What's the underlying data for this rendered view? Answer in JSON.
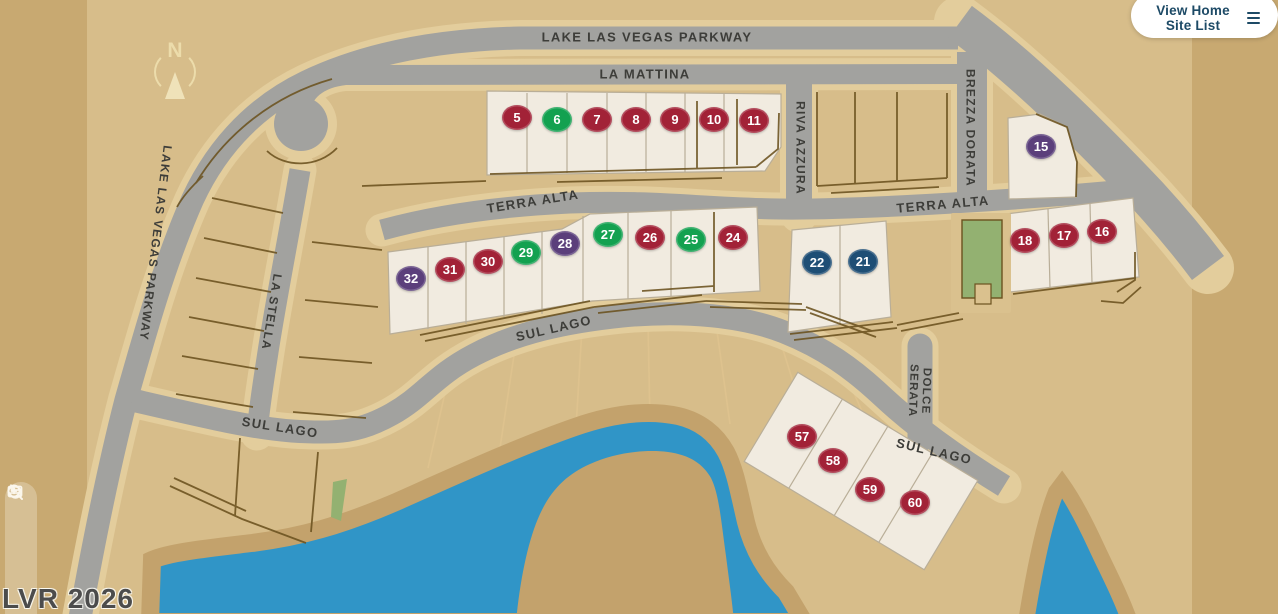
{
  "page": {
    "view_button": {
      "label": "View Home Site List",
      "icon": "list-icon",
      "text_color": "#1d4a66"
    },
    "watermark": "LVR 2026",
    "compass_label": "N",
    "controls": [
      {
        "name": "fit-view"
      },
      {
        "name": "zoom-in"
      },
      {
        "name": "zoom-out"
      },
      {
        "name": "reset-view"
      }
    ]
  },
  "map": {
    "theme": {
      "outer": "#c8a971",
      "map": "#d7bd8a",
      "road": "#a2a29f",
      "roadpad": "#e3cd9c",
      "water": "#3095c7",
      "shore": "#c3a26c",
      "lot": "#f1ebe0",
      "lotline": "#b9ae98",
      "green": "#93b171",
      "ink": "#6b521f",
      "label": "#3d3d39",
      "faint": "#e0c48f",
      "btn": "#1d4a66"
    },
    "status_colors": {
      "red": "#a22237",
      "green": "#13a150",
      "purple": "#5b3f7b",
      "navy": "#1e4e75"
    },
    "street_labels": [
      {
        "text": "LAKE LAS VEGAS PARKWAY",
        "x": 647,
        "y": 38,
        "rot": 0,
        "size": 13
      },
      {
        "text": "LA MATTINA",
        "x": 645,
        "y": 75,
        "rot": 0,
        "size": 13
      },
      {
        "text": "RIVA AZZURA",
        "x": 800,
        "y": 148,
        "rot": 90,
        "size": 12
      },
      {
        "text": "BREZZA DORATA",
        "x": 970,
        "y": 128,
        "rot": 90,
        "size": 12
      },
      {
        "text": "TERRA ALTA",
        "x": 533,
        "y": 202,
        "rot": -9,
        "size": 13
      },
      {
        "text": "TERRA ALTA",
        "x": 943,
        "y": 205,
        "rot": -5,
        "size": 13
      },
      {
        "text": "LAKE LAS VEGAS PARKWAY",
        "x": 155,
        "y": 243,
        "rot": 97,
        "size": 12
      },
      {
        "text": "LA STELLA",
        "x": 271,
        "y": 312,
        "rot": 99,
        "size": 12
      },
      {
        "text": "SUL LAGO",
        "x": 280,
        "y": 428,
        "rot": 9,
        "size": 13
      },
      {
        "text": "SUL LAGO",
        "x": 554,
        "y": 329,
        "rot": -13,
        "size": 13
      },
      {
        "text": "SUL LAGO",
        "x": 934,
        "y": 452,
        "rot": 13,
        "size": 13
      },
      {
        "text": "DOLCE\nSERATA",
        "x": 919,
        "y": 391,
        "rot": 92,
        "size": 11.5
      }
    ],
    "lots": [
      {
        "num": "5",
        "x": 517,
        "y": 117,
        "color": "red"
      },
      {
        "num": "6",
        "x": 557,
        "y": 119,
        "color": "green"
      },
      {
        "num": "7",
        "x": 597,
        "y": 119,
        "color": "red"
      },
      {
        "num": "8",
        "x": 636,
        "y": 119,
        "color": "red"
      },
      {
        "num": "9",
        "x": 675,
        "y": 119,
        "color": "red"
      },
      {
        "num": "10",
        "x": 714,
        "y": 119,
        "color": "red"
      },
      {
        "num": "11",
        "x": 754,
        "y": 120,
        "color": "red"
      },
      {
        "num": "15",
        "x": 1041,
        "y": 146,
        "color": "purple"
      },
      {
        "num": "16",
        "x": 1102,
        "y": 231,
        "color": "red"
      },
      {
        "num": "17",
        "x": 1064,
        "y": 235,
        "color": "red"
      },
      {
        "num": "18",
        "x": 1025,
        "y": 240,
        "color": "red"
      },
      {
        "num": "21",
        "x": 863,
        "y": 261,
        "color": "navy"
      },
      {
        "num": "22",
        "x": 817,
        "y": 262,
        "color": "navy"
      },
      {
        "num": "24",
        "x": 733,
        "y": 237,
        "color": "red"
      },
      {
        "num": "25",
        "x": 691,
        "y": 239,
        "color": "green"
      },
      {
        "num": "26",
        "x": 650,
        "y": 237,
        "color": "red"
      },
      {
        "num": "27",
        "x": 608,
        "y": 234,
        "color": "green"
      },
      {
        "num": "28",
        "x": 565,
        "y": 243,
        "color": "purple"
      },
      {
        "num": "29",
        "x": 526,
        "y": 252,
        "color": "green"
      },
      {
        "num": "30",
        "x": 488,
        "y": 261,
        "color": "red"
      },
      {
        "num": "31",
        "x": 450,
        "y": 269,
        "color": "red"
      },
      {
        "num": "32",
        "x": 411,
        "y": 278,
        "color": "purple"
      },
      {
        "num": "57",
        "x": 802,
        "y": 436,
        "color": "red"
      },
      {
        "num": "58",
        "x": 833,
        "y": 460,
        "color": "red"
      },
      {
        "num": "59",
        "x": 870,
        "y": 489,
        "color": "red"
      },
      {
        "num": "60",
        "x": 915,
        "y": 502,
        "color": "red"
      }
    ]
  }
}
